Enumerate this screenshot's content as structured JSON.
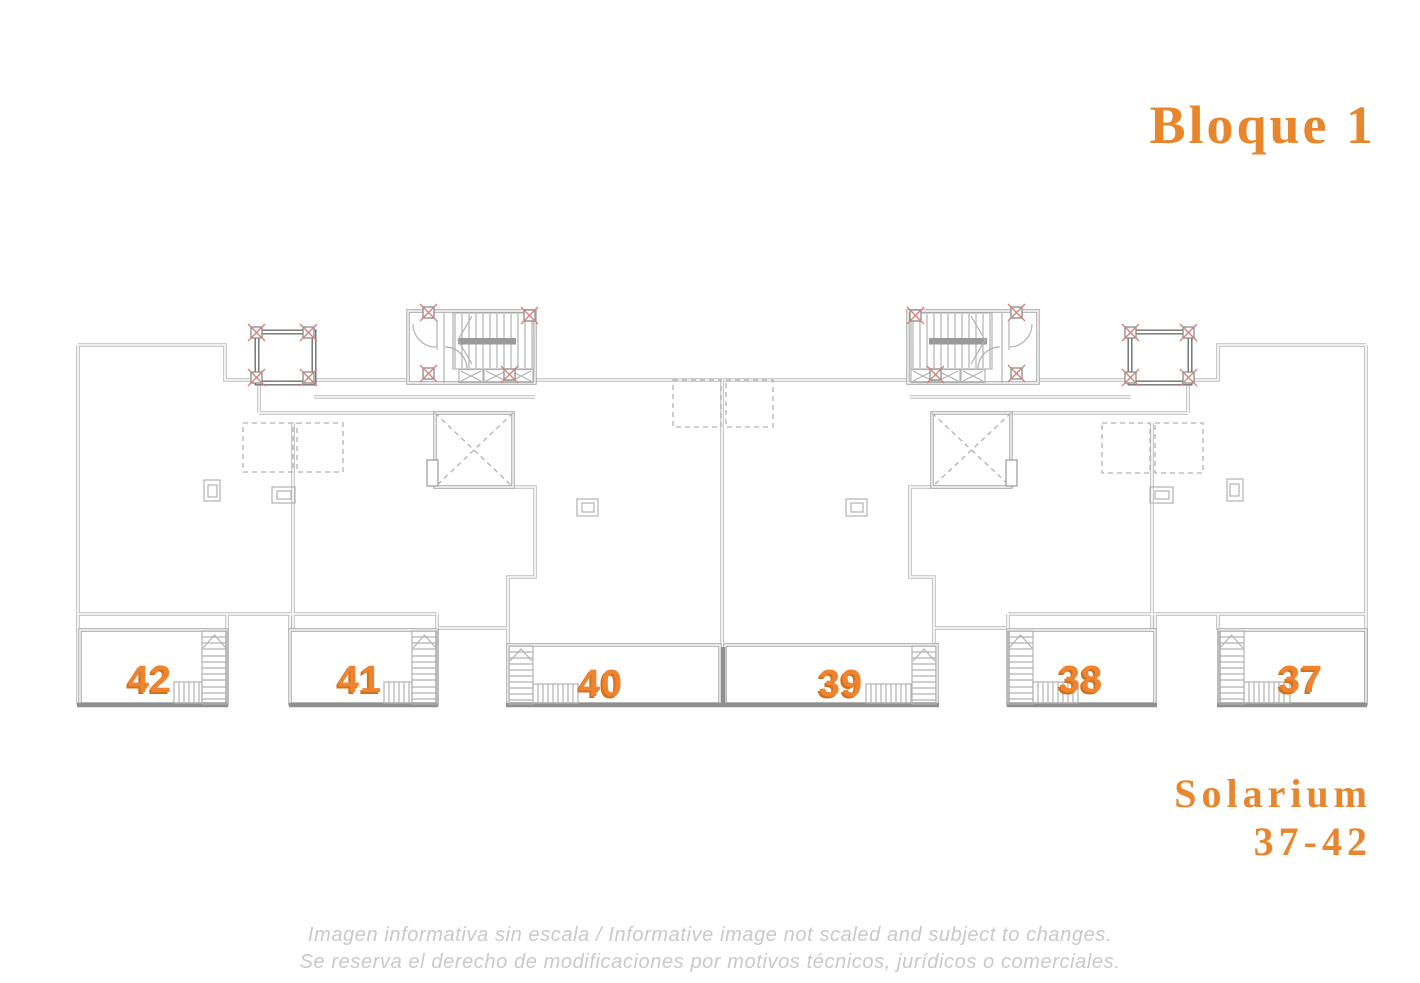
{
  "header": {
    "title": "Bloque 1"
  },
  "plan": {
    "floor_name": "Solarium",
    "units": [
      {
        "label": "42"
      },
      {
        "label": "41"
      },
      {
        "label": "40"
      },
      {
        "label": "39"
      },
      {
        "label": "38"
      },
      {
        "label": "37"
      }
    ]
  },
  "solarium": {
    "line1": "Solarium",
    "line2": "37-42"
  },
  "disclaimer": {
    "line1": "Imagen informativa sin escala /  Informative image not scaled and subject to changes.",
    "line2": "Se reserva el derecho de modificaciones por motivos técnicos, jurídicos o comerciales."
  },
  "colors": {
    "accent": "#e8862d",
    "unit-number": "#ee8430",
    "unit-number-shadow": "#d2711c",
    "line-light": "#bcbcbc",
    "line-mid": "#a2a2a2",
    "line-dark": "#6e6e6e",
    "line-thin": "#b2b2b2",
    "column-red": "#d4837a",
    "disclaimer-gray": "#c9c9c9"
  }
}
